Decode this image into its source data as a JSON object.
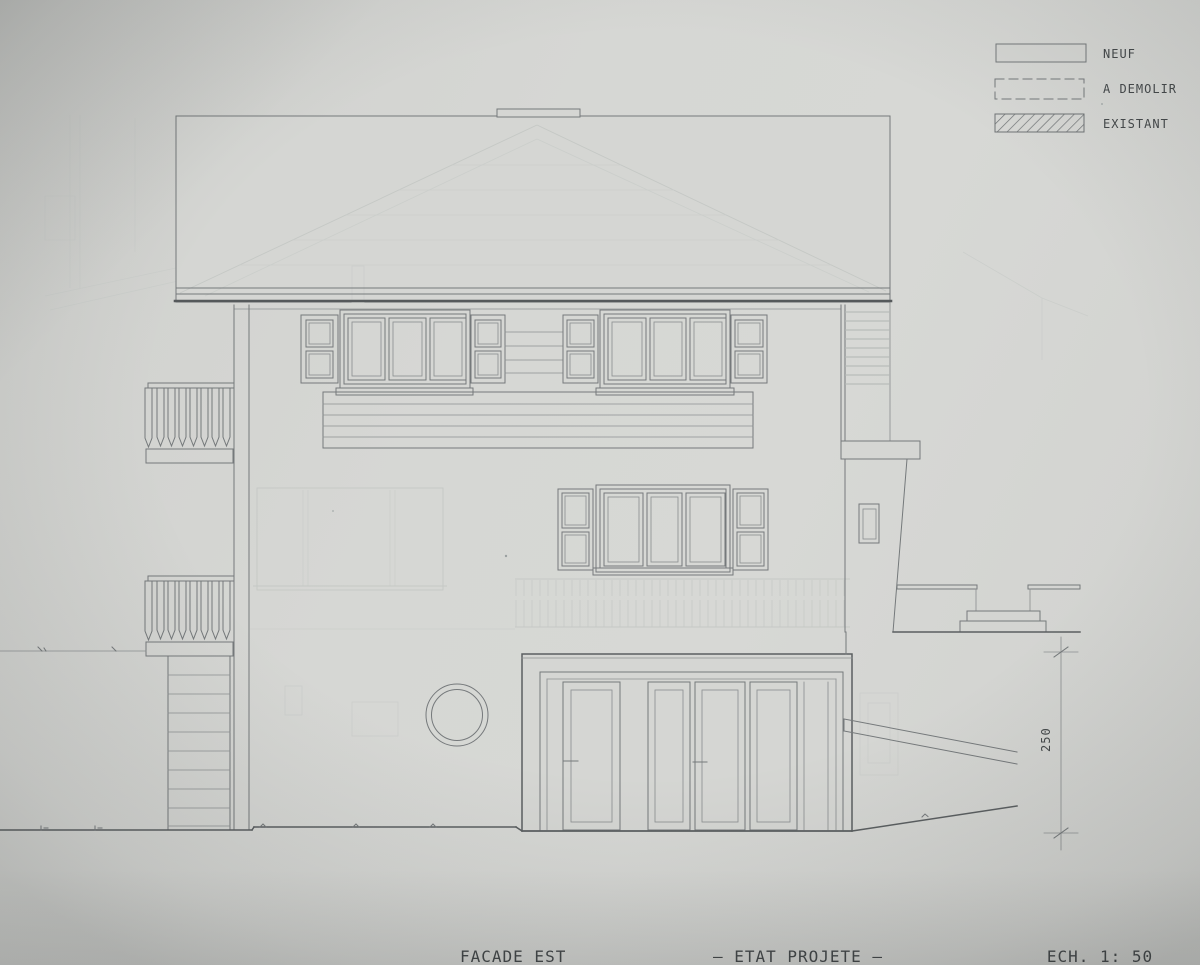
{
  "drawing": {
    "caption_title": "FACADE EST",
    "caption_state": "— ETAT PROJETE —",
    "caption_scale": "ECH. 1: 50"
  },
  "legend": {
    "items": [
      {
        "label": "NEUF",
        "swatch": "solid-outline"
      },
      {
        "label": "A DEMOLIR",
        "swatch": "dashed-outline"
      },
      {
        "label": "EXISTANT",
        "swatch": "diagonal-hatch"
      }
    ]
  },
  "dimensions": {
    "right_height_label": "250"
  },
  "colors": {
    "paper": "#d4d5d2",
    "ink": "#75797b",
    "ink_dark": "#55595b",
    "ghost": "#c5c8c5",
    "text": "#45494b"
  }
}
